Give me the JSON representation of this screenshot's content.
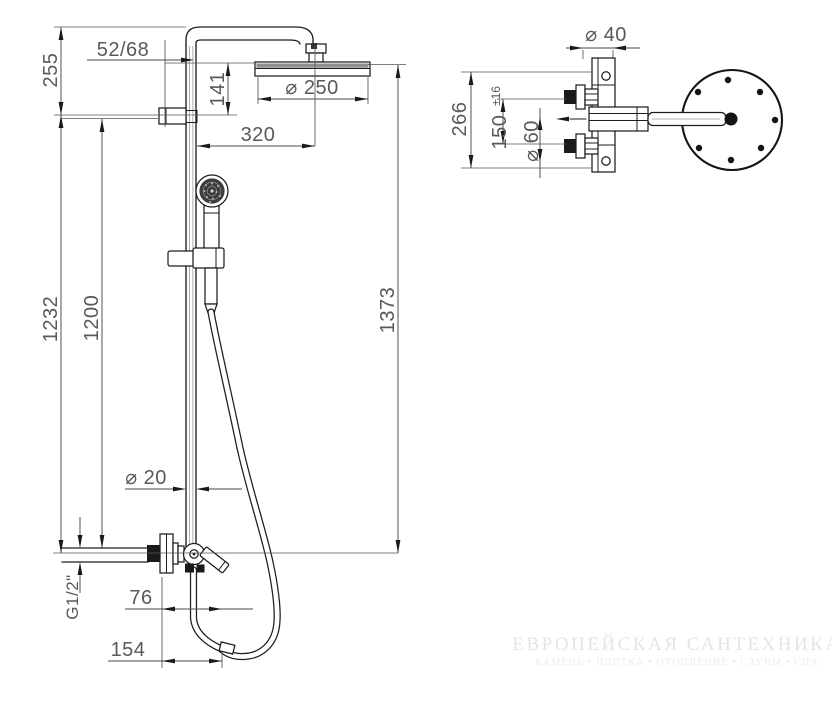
{
  "front": {
    "dim_wall_offset": "52/68",
    "dim_top_section": "255",
    "dim_head_drop": "141",
    "dim_head_diameter": "⌀ 250",
    "dim_head_projection": "320",
    "dim_column_height": "1232",
    "dim_rail_height": "1200",
    "dim_total_height": "1373",
    "dim_pipe_diameter": "⌀ 20",
    "dim_thread": "G1/2\"",
    "dim_spout_projection": "76",
    "dim_hose_projection": "154"
  },
  "side": {
    "dim_plate_width": "⌀ 40",
    "dim_body_height": "266",
    "dim_inlet_spacing": "150",
    "dim_inlet_tolerance": "±16",
    "dim_rosette_diameter": "⌀ 60"
  },
  "watermark": {
    "title": "ЕВРОПЕЙСКАЯ САНТЕХНИКА",
    "subtitle": "КАМЕНЬ • ПЛИТКА • ОТОПЛЕНИЕ • САУНЫ • СПА"
  },
  "colors": {
    "line": "#1d1d1d",
    "dim_line": "#4a4a4a",
    "dim_text": "#595959",
    "watermark_title": "#e7e4e1",
    "watermark_subtitle": "#edebe8",
    "background": "#ffffff"
  }
}
